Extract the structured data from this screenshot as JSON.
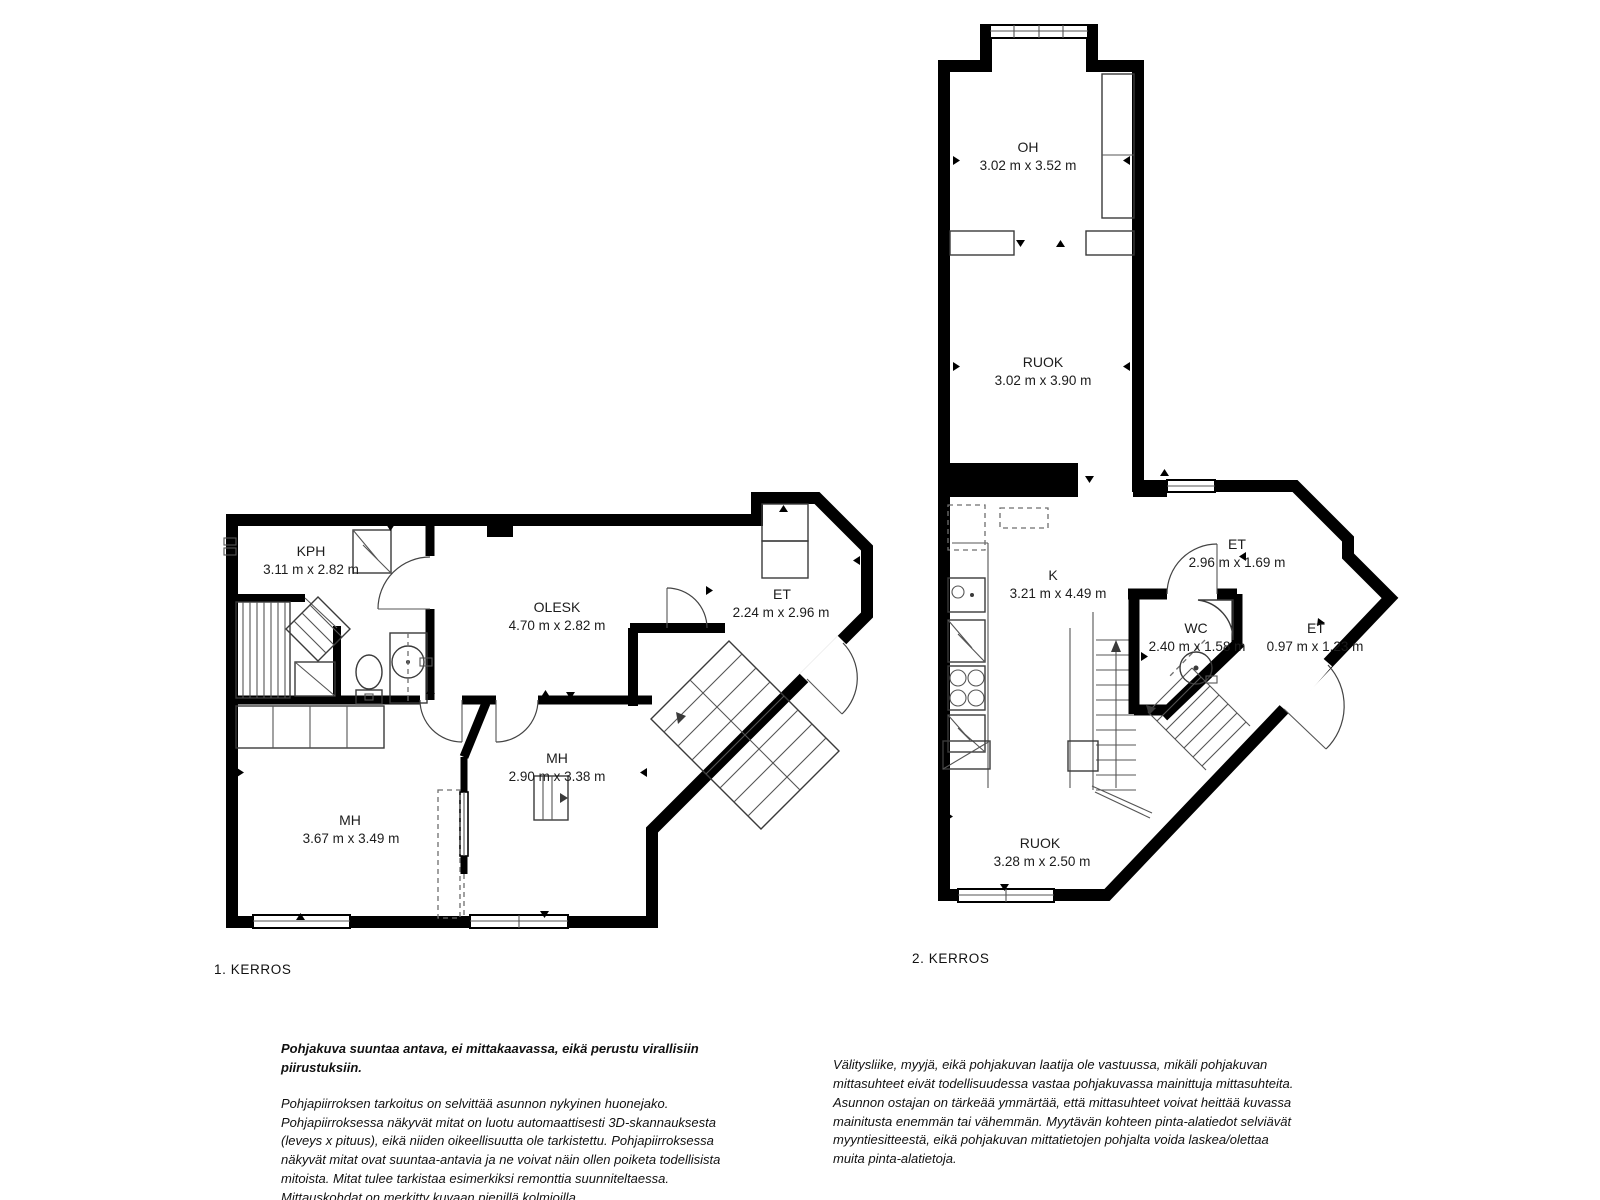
{
  "page": {
    "background": "#ffffff"
  },
  "colors": {
    "wall": "#000000",
    "fixture_line": "#3a3a3a",
    "text": "#1c1c1c"
  },
  "floors": [
    {
      "name": "1. KERROS",
      "rooms": [
        {
          "label": "KPH",
          "dims": "3.11 m x 2.82 m"
        },
        {
          "label": "OLESK",
          "dims": "4.70 m x 2.82 m"
        },
        {
          "label": "ET",
          "dims": "2.24 m x 2.96 m"
        },
        {
          "label": "MH",
          "dims": "2.90 m x 3.38 m"
        },
        {
          "label": "MH",
          "dims": "3.67 m x 3.49 m"
        }
      ]
    },
    {
      "name": "2. KERROS",
      "rooms": [
        {
          "label": "OH",
          "dims": "3.02 m x 3.52 m"
        },
        {
          "label": "RUOK",
          "dims": "3.02 m x 3.90 m"
        },
        {
          "label": "K",
          "dims": "3.21 m x 4.49 m"
        },
        {
          "label": "ET",
          "dims": "2.96 m x 1.69 m"
        },
        {
          "label": "WC",
          "dims": "2.40 m x 1.58 m"
        },
        {
          "label": "ET",
          "dims": "0.97 m x 1.23 m"
        },
        {
          "label": "RUOK",
          "dims": "3.28 m x 2.50 m"
        }
      ]
    }
  ],
  "footer": {
    "left_title": "Pohjakuva suuntaa antava, ei mittakaavassa, eikä perustu virallisiin piirustuksiin.",
    "left_body": "Pohjapiirroksen tarkoitus on selvittää asunnon nykyinen huonejako. Pohjapiirroksessa näkyvät mitat on luotu automaattisesti 3D-skannauksesta (leveys x pituus), eikä niiden oikeellisuutta ole tarkistettu. Pohjapiirroksessa näkyvät mitat ovat suuntaa-antavia ja ne voivat näin ollen poiketa todellisista mitoista. Mitat tulee tarkistaa esimerkiksi remonttia suunniteltaessa. Mittauskohdat on merkitty kuvaan pienillä kolmioilla.",
    "right_body": "Välitysliike, myyjä, eikä pohjakuvan laatija ole vastuussa, mikäli pohjakuvan mittasuhteet eivät todellisuudessa vastaa pohjakuvassa mainittuja mittasuhteita. Asunnon ostajan on tärkeää ymmärtää, että mittasuhteet voivat heittää kuvassa mainitusta enemmän tai vähemmän. Myytävän kohteen pinta-alatiedot selviävät myyntiesitteestä, eikä pohjakuvan mittatietojen pohjalta voida laskea/olettaa muita pinta-alatietoja."
  }
}
